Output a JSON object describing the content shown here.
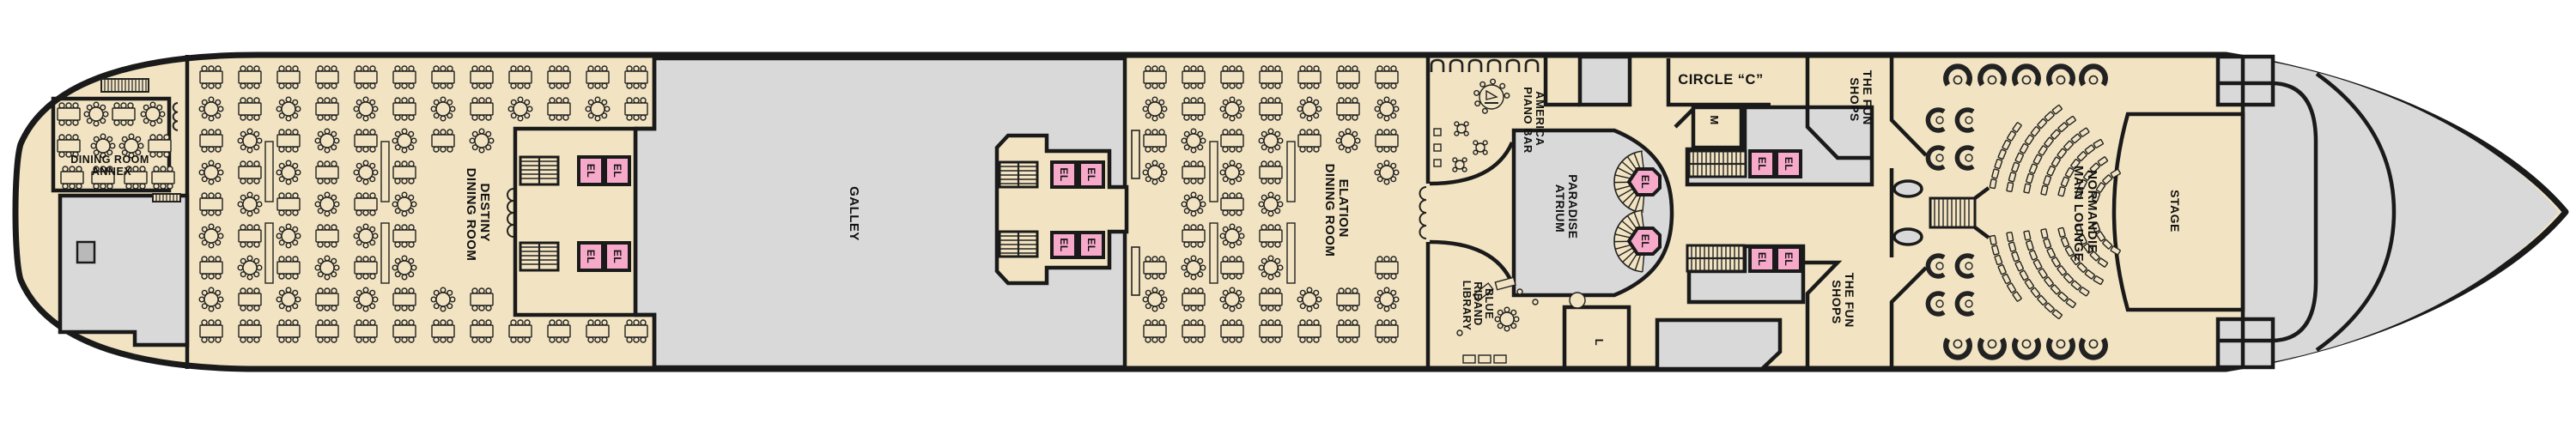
{
  "colors": {
    "deck": "#f2e4c2",
    "service_gray": "#d9d9d9",
    "dark_gray": "#b9b9b9",
    "elevator_pink": "#f7a9ca",
    "wall": "#1a1a1a",
    "furniture_line": "#222222",
    "background": "#ffffff"
  },
  "labels": {
    "dining_room_annex": {
      "line1": "DINING ROOM",
      "line2": "ANNEX"
    },
    "destiny": {
      "line1": "DESTINY",
      "line2": "DINING ROOM"
    },
    "galley": "GALLEY",
    "elation": {
      "line1": "ELATION",
      "line2": "DINING ROOM"
    },
    "america_piano_bar": {
      "line1": "AMERICA",
      "line2": "PIANO BAR"
    },
    "blue_riband_library": {
      "line1": "BLUE",
      "line2": "RIBAND",
      "line3": "LIBRARY"
    },
    "paradise_atrium": {
      "line1": "PARADISE",
      "line2": "ATRIUM"
    },
    "circle_c": "CIRCLE “C”",
    "mens_room": "M",
    "ladies_room": "L",
    "fun_shops": {
      "line1": "THE FUN",
      "line2": "SHOPS"
    },
    "normandie_main_lounge": {
      "line1": "NORMANDIE",
      "line2": "MAIN LOUNGE"
    },
    "stage": "STAGE",
    "elevator": "EL"
  }
}
